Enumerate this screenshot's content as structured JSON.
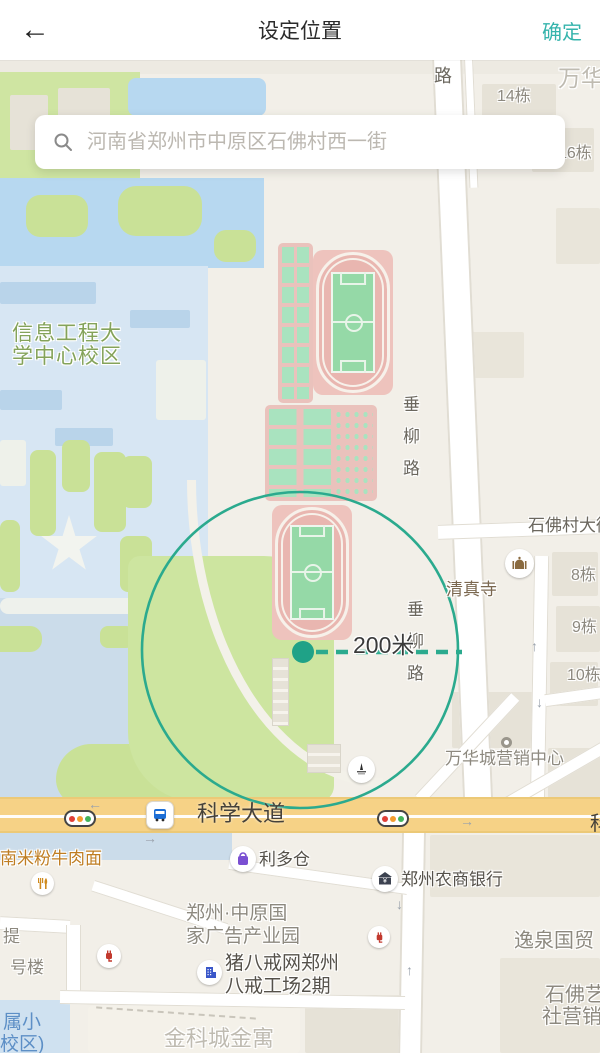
{
  "header": {
    "back_icon": "←",
    "title": "设定位置",
    "confirm_label": "确定"
  },
  "search": {
    "placeholder": "河南省郑州市中原区石佛村西一街"
  },
  "map": {
    "radius_label": "200米",
    "road_labels": {
      "road_partial_top": "路",
      "chuiliu_1": "垂",
      "chuiliu_2": "柳",
      "chuiliu_3": "路",
      "kexue_dadao": "科学大道",
      "kexue_partial_right": "科",
      "shifocun_street": "石佛村大街"
    },
    "poi_labels": {
      "wanhua": "万华",
      "building_14": "14栋",
      "building_16": "16栋",
      "building_8": "8栋",
      "building_9": "9栋",
      "building_10": "10栋",
      "university_line1": "信息工程大",
      "university_line2": "学中心校区",
      "mosque": "清真寺",
      "wanhua_sales_center": "万华城营销中心",
      "noodle_shop": "南米粉牛肉面",
      "liduocang": "利多仓",
      "bank": "郑州农商银行",
      "ad_park_line1": "郑州·中原国",
      "ad_park_line2": "家广告产业园",
      "zhubajie_line1": "猪八戒网郑州",
      "zhubajie_line2": "八戒工场2期",
      "jinkecheng": "金科城金寓",
      "yiquan": "逸泉国贸",
      "shifo_art_line1": "石佛艺",
      "shifo_art_line2": "社营销",
      "ti": "提",
      "haolou": "号楼",
      "school_line1": "属小",
      "school_line2": "校区)"
    },
    "colors": {
      "accent": "#35b4ac",
      "circle": "#2baa8e",
      "dot": "#1fa287"
    }
  }
}
